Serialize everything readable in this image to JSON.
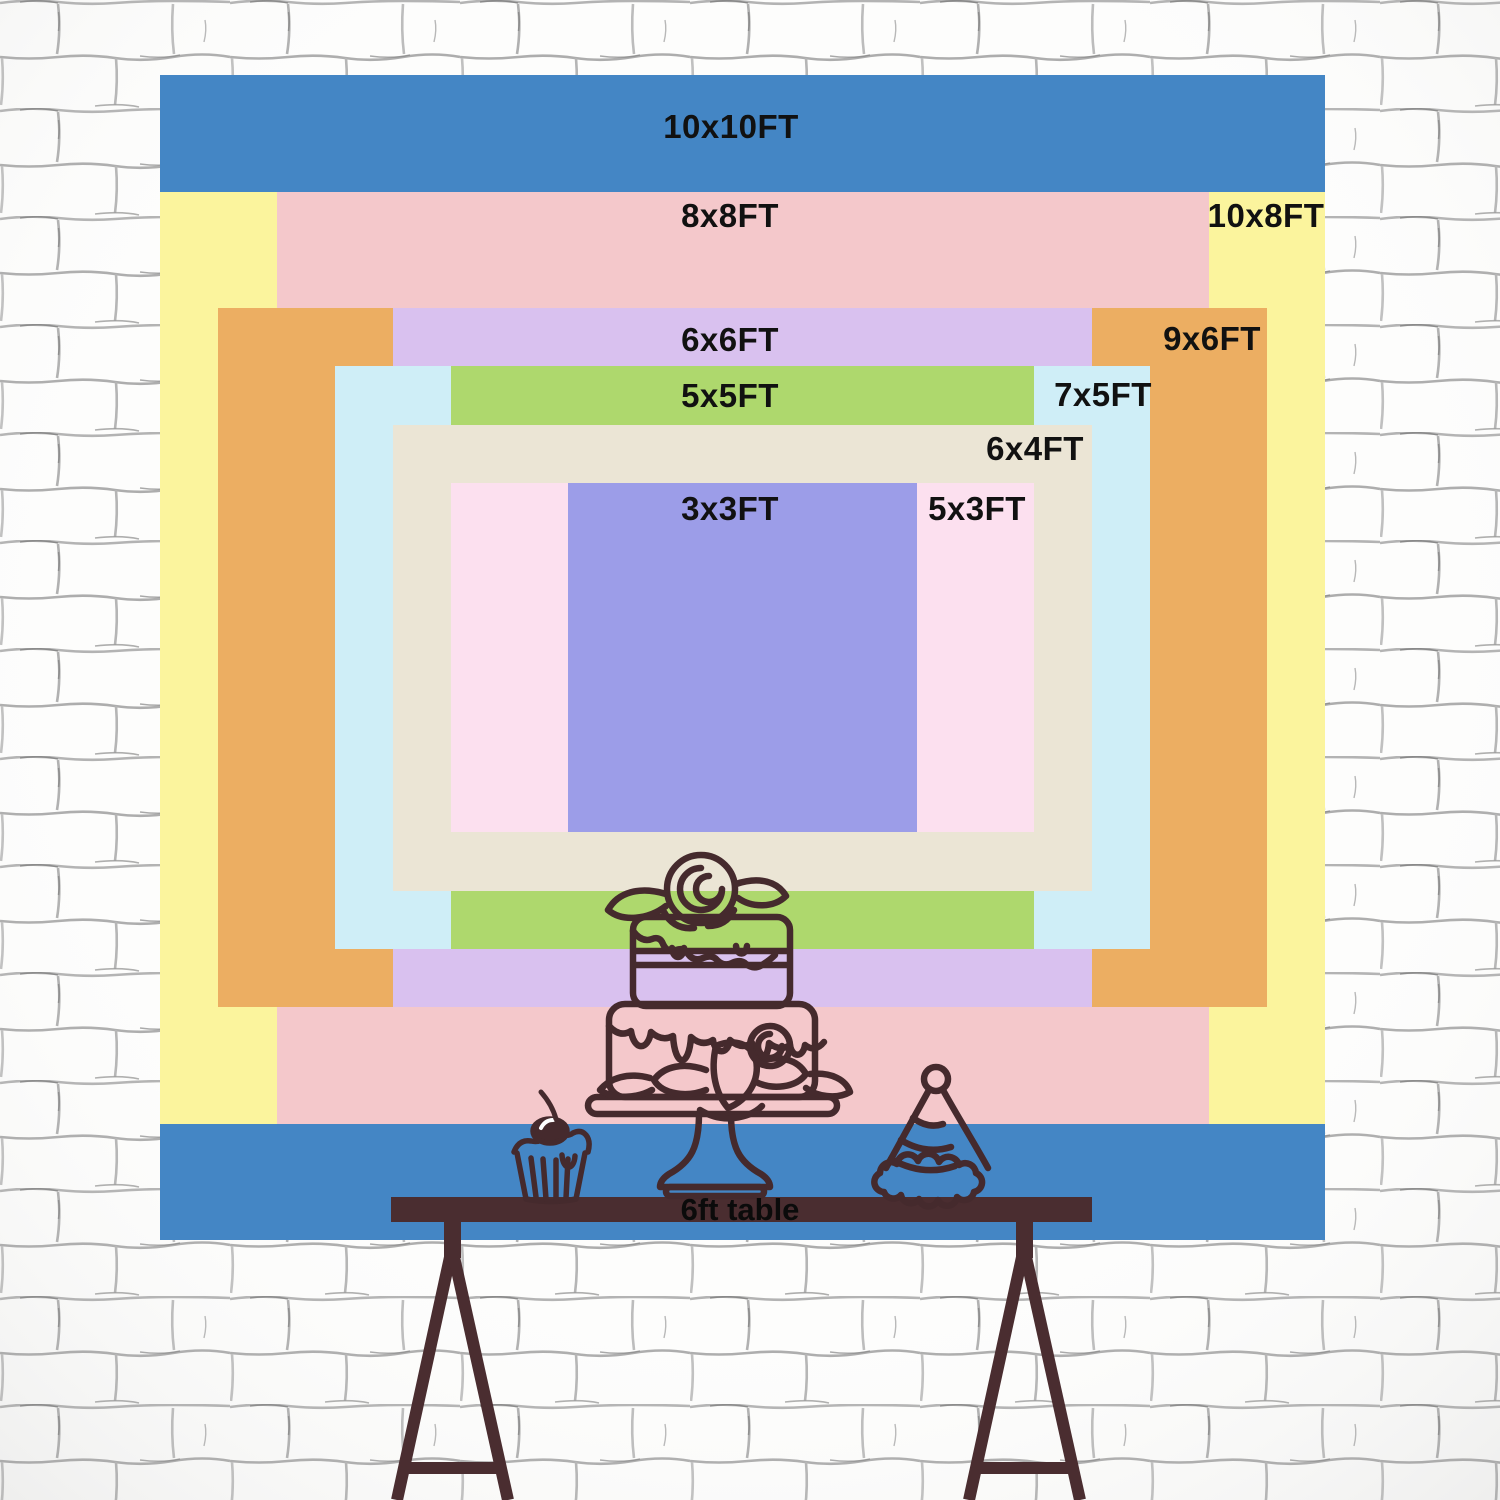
{
  "backdrop": {
    "unit": "FT",
    "scale_px_per_ft": 116.5,
    "center_x": 742.5,
    "top_y": 75,
    "label_color": "#111111",
    "sizes": [
      {
        "id": "10x10ft",
        "label": "10x10FT",
        "width_ft": 10,
        "height_ft": 10,
        "top_inset_ft": 0,
        "color": "#4486c5",
        "label_x": 731,
        "label_y": 127
      },
      {
        "id": "10x8ft",
        "label": "10x8FT",
        "width_ft": 10,
        "height_ft": 8,
        "top_inset_ft": 1,
        "color": "#fbf49d",
        "label_x": 1266,
        "label_y": 216
      },
      {
        "id": "8x8ft",
        "label": "8x8FT",
        "width_ft": 8,
        "height_ft": 8,
        "top_inset_ft": 1,
        "color": "#f4c8cb",
        "label_x": 730,
        "label_y": 216
      },
      {
        "id": "9x6ft",
        "label": "9x6FT",
        "width_ft": 9,
        "height_ft": 6,
        "top_inset_ft": 2,
        "color": "#ecae62",
        "label_x": 1212,
        "label_y": 339
      },
      {
        "id": "6x6ft",
        "label": "6x6FT",
        "width_ft": 6,
        "height_ft": 6,
        "top_inset_ft": 2,
        "color": "#d9c1ef",
        "label_x": 730,
        "label_y": 340
      },
      {
        "id": "7x5ft",
        "label": "7x5FT",
        "width_ft": 7,
        "height_ft": 5,
        "top_inset_ft": 2.5,
        "color": "#cfeef7",
        "label_x": 1103,
        "label_y": 395
      },
      {
        "id": "5x5ft",
        "label": "5x5FT",
        "width_ft": 5,
        "height_ft": 5,
        "top_inset_ft": 2.5,
        "color": "#aed86d",
        "label_x": 730,
        "label_y": 396
      },
      {
        "id": "6x4ft",
        "label": "6x4FT",
        "width_ft": 6,
        "height_ft": 4,
        "top_inset_ft": 3,
        "color": "#ebe5d5",
        "label_x": 1035,
        "label_y": 449
      },
      {
        "id": "5x3ft",
        "label": "5x3FT",
        "width_ft": 5,
        "height_ft": 3,
        "top_inset_ft": 3.5,
        "color": "#fce0ef",
        "label_x": 977,
        "label_y": 509
      },
      {
        "id": "3x3ft",
        "label": "3x3FT",
        "width_ft": 3,
        "height_ft": 3,
        "top_inset_ft": 3.5,
        "color": "#9c9de8",
        "label_x": 730,
        "label_y": 509
      }
    ]
  },
  "table": {
    "label": "6ft table",
    "color": "#4a2d30"
  },
  "illustrations": {
    "line_color": "#452a2d",
    "items": [
      "cake-on-stand",
      "cupcake-with-cherry",
      "party-hat"
    ]
  },
  "wall": {
    "brick_color": "#fdfdfc",
    "mortar_color": "#9a9a9a"
  }
}
